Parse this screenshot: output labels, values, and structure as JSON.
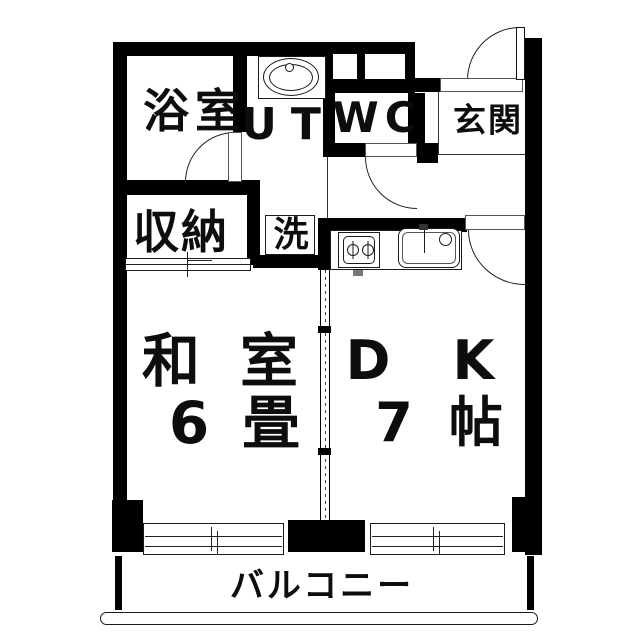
{
  "title": "apartment-floor-plan",
  "rooms": {
    "bathroom": {
      "label": "浴室"
    },
    "utility": {
      "label": "UT"
    },
    "toilet": {
      "label": "WC"
    },
    "entrance": {
      "label": "玄関"
    },
    "storage": {
      "label": "収納"
    },
    "laundry": {
      "label": "洗"
    },
    "japanese_room": {
      "label": "和室",
      "size": "6畳"
    },
    "dining_kitchen": {
      "label": "DK",
      "size": "7帖"
    },
    "balcony": {
      "label": "バルコニー"
    }
  },
  "colors": {
    "wall": "#000000",
    "floor": "#ffffff",
    "line": "#333333"
  }
}
